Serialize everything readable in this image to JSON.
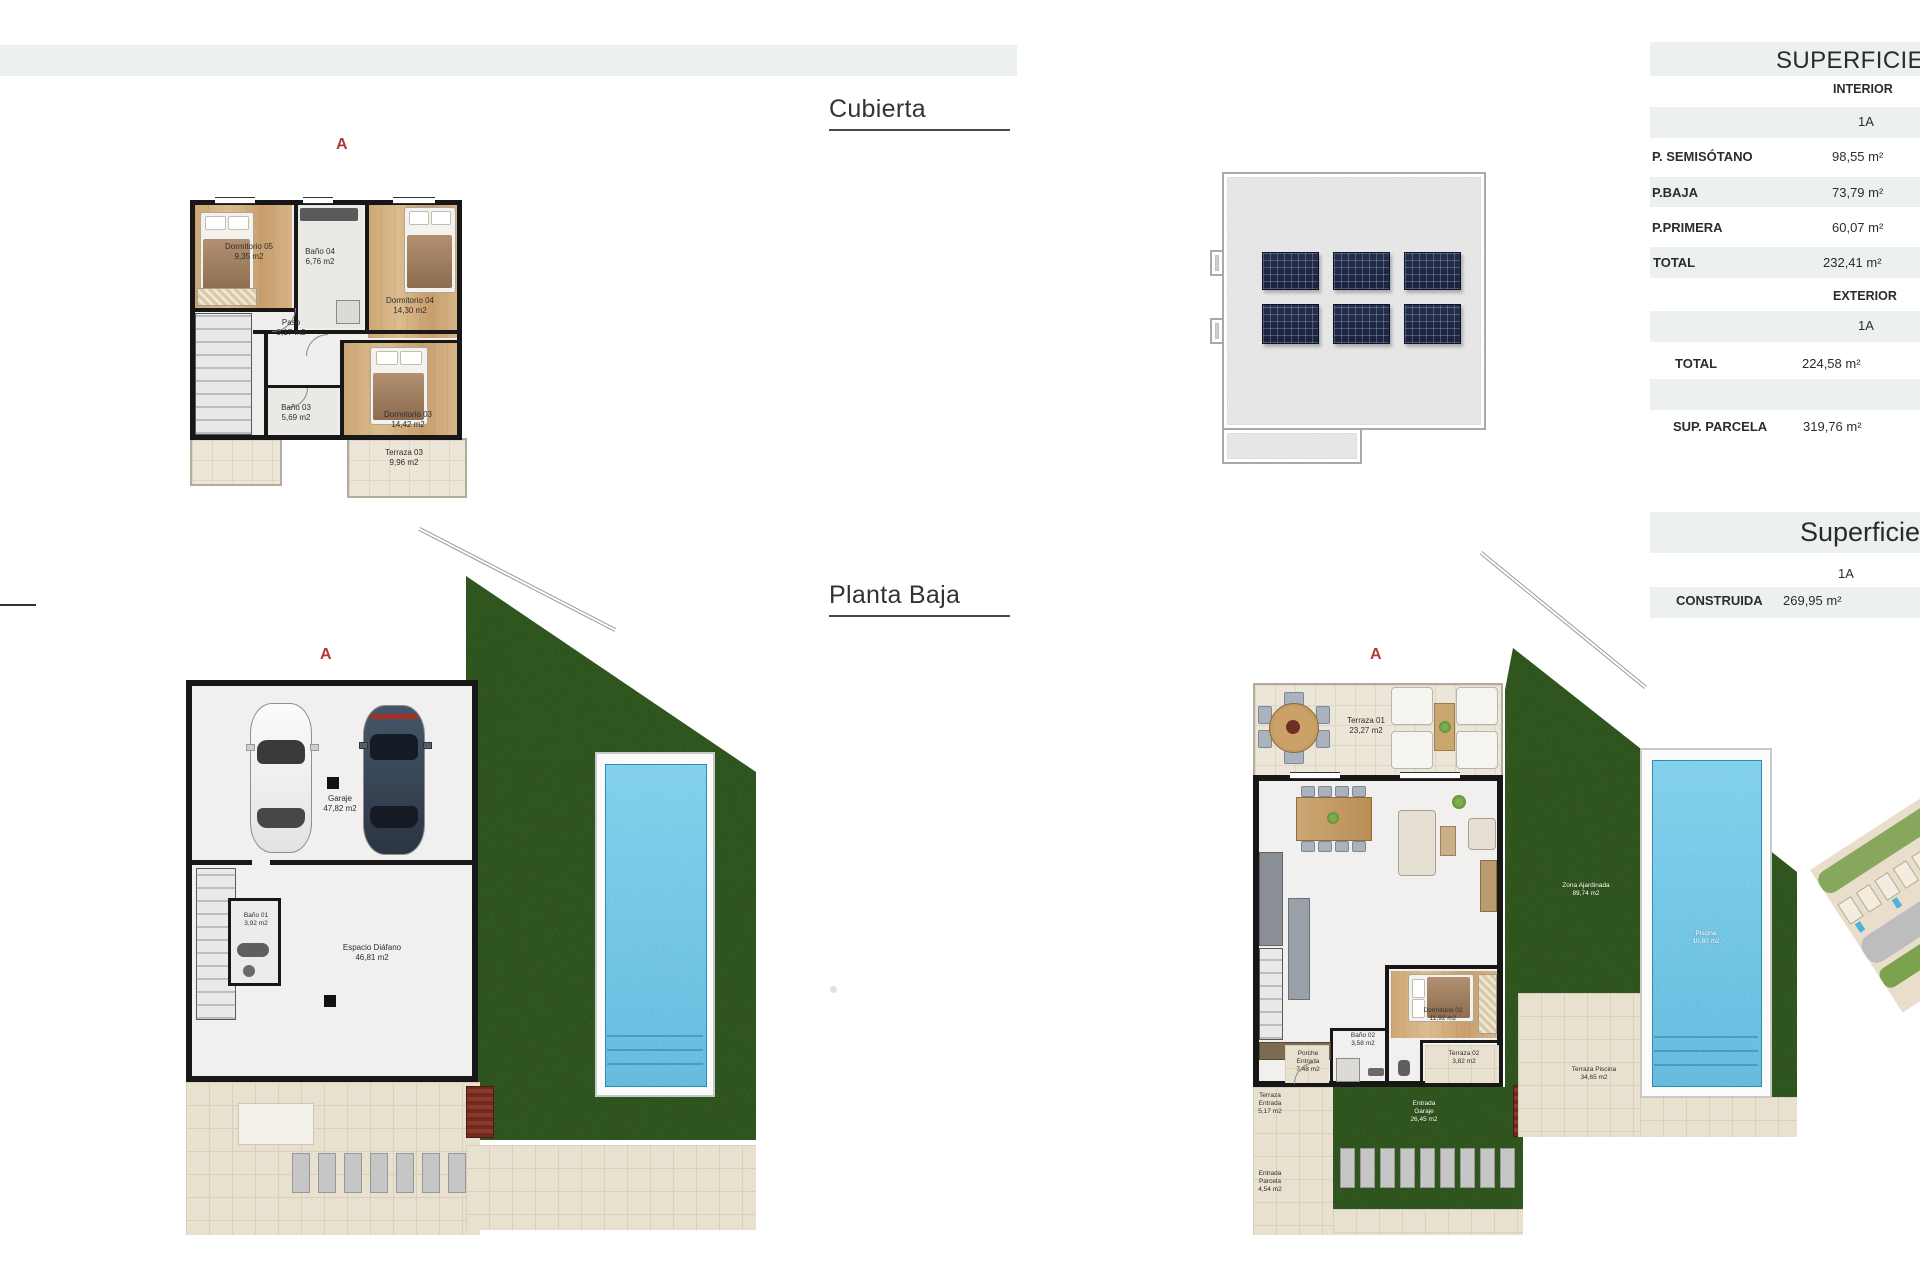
{
  "headings": {
    "cubierta": "Cubierta",
    "planta_baja": "Planta Baja"
  },
  "plans": {
    "primera": {
      "marker": "A",
      "rooms": [
        {
          "label": "Dormitorio 05",
          "area": "9,35 m2"
        },
        {
          "label": "Baño 04",
          "area": "6,76 m2"
        },
        {
          "label": "Dormitorio 04",
          "area": "14,30 m2"
        },
        {
          "label": "Paso",
          "area": "9,17 m2"
        },
        {
          "label": "Baño 03",
          "area": "5,69 m2"
        },
        {
          "label": "Dormitorio 03",
          "area": "14,42 m2"
        },
        {
          "label": "Terraza 03",
          "area": "9,96 m2"
        }
      ]
    },
    "semisotano": {
      "marker": "A",
      "rooms": [
        {
          "label": "Garaje",
          "area": "47,82 m2"
        },
        {
          "label": "Baño 01",
          "area": "3,92 m2"
        },
        {
          "label": "Espacio Diáfano",
          "area": "46,81 m2"
        }
      ]
    },
    "baja": {
      "marker": "A",
      "rooms": [
        {
          "label": "Terraza 01",
          "area": "23,27 m2"
        },
        {
          "label": "Salón-Comedor-Cocina",
          "area": "58,29 m2"
        },
        {
          "label": "Dormitorio 02",
          "area": "11,92 m2"
        },
        {
          "label": "Baño 02",
          "area": "3,58 m2"
        },
        {
          "label": "Terraza 02",
          "area": "3,82 m2"
        },
        {
          "label": "Porche Entrada",
          "area": "7,48 m2"
        },
        {
          "label": "Terraza Entrada",
          "area": "5,17 m2"
        },
        {
          "label": "Entrada Garaje",
          "area": "26,45 m2"
        },
        {
          "label": "Entrada Parcela",
          "area": "4,54 m2"
        },
        {
          "label": "Zona Ajardinada",
          "area": "89,74 m2"
        },
        {
          "label": "Piscina",
          "area": "10,80 m2"
        },
        {
          "label": "Terraza Piscina",
          "area": "34,65 m2"
        }
      ]
    }
  },
  "panel": {
    "table1": {
      "title": "SUPERFICIES",
      "interior_heading": "INTERIOR",
      "interior_column": "1A",
      "interior_rows": [
        {
          "label": "P. SEMISÓTANO",
          "value": "98,55 m²"
        },
        {
          "label": "P.BAJA",
          "value": "73,79 m²"
        },
        {
          "label": "P.PRIMERA",
          "value": "60,07 m²"
        },
        {
          "label": "TOTAL",
          "value": "232,41 m²"
        }
      ],
      "exterior_heading": "EXTERIOR",
      "exterior_column": "1A",
      "exterior_rows": [
        {
          "label": "TOTAL",
          "value": "224,58 m²"
        }
      ],
      "parcela_row": {
        "label": "SUP. PARCELA",
        "value": "319,76 m²"
      }
    },
    "table2": {
      "title": "Superficies",
      "column": "1A",
      "row": {
        "label": "CONSTRUIDA",
        "value": "269,95 m²"
      }
    }
  }
}
